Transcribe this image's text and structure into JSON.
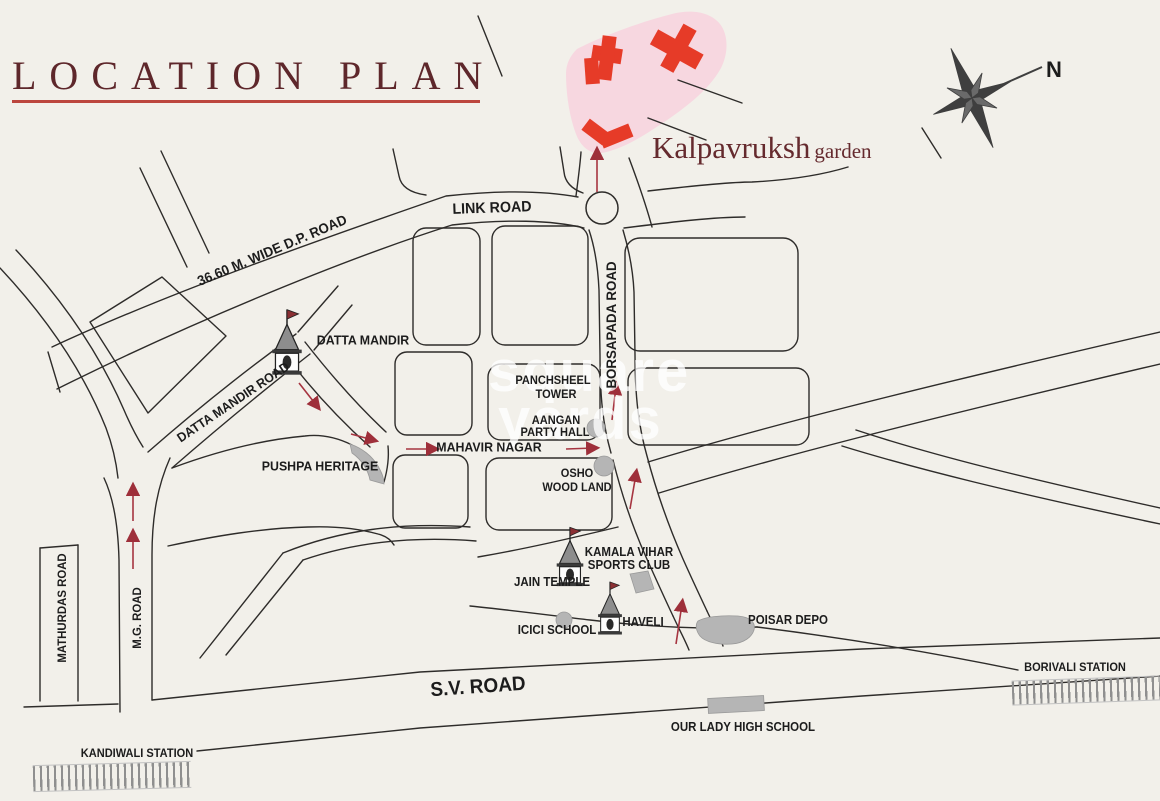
{
  "title": "LOCATION PLAN",
  "site": {
    "name": "Kalpavruksh",
    "suffix": "garden"
  },
  "compass_label": "N",
  "watermark": {
    "line1": "square",
    "line2": "yards"
  },
  "roads": {
    "link": "LINK ROAD",
    "dp": "36.60  M. WIDE D.P. ROAD",
    "datta_mandir": "DATTA MANDIR ROAD",
    "borsapada": "BORSAPADA ROAD",
    "mahavir": "MAHAVIR NAGAR",
    "mg": "M.G. ROAD",
    "mathurdas": "MATHURDAS ROAD",
    "sv": "S.V. ROAD"
  },
  "places": {
    "datta_mandir": "DATTA MANDIR",
    "pushpa": "PUSHPA HERITAGE",
    "panchsheel1": "PANCHSHEEL",
    "panchsheel2": "TOWER",
    "aangan1": "AANGAN",
    "aangan2": "PARTY HALL",
    "osho1": "OSHO",
    "osho2": "WOOD LAND",
    "kamala1": "KAMALA VIHAR",
    "kamala2": "SPORTS CLUB",
    "jain": "JAIN TEMPLE",
    "icici": "ICICI SCHOOL",
    "haveli": "HAVELI",
    "poisar": "POISAR DEPO",
    "our_lady": "OUR LADY HIGH SCHOOL"
  },
  "stations": {
    "borivali": "BORIVALI STATION",
    "kandiwali": "KANDIWALI STATION"
  },
  "colors": {
    "accent_maroon": "#5e272b",
    "underline_red": "#bc463e",
    "building_red": "#e63b28",
    "site_pink": "#f7d7e0",
    "arrow_red": "#a63440",
    "grey_building": "#b5b5b5",
    "map_line": "#2e2c2a"
  }
}
